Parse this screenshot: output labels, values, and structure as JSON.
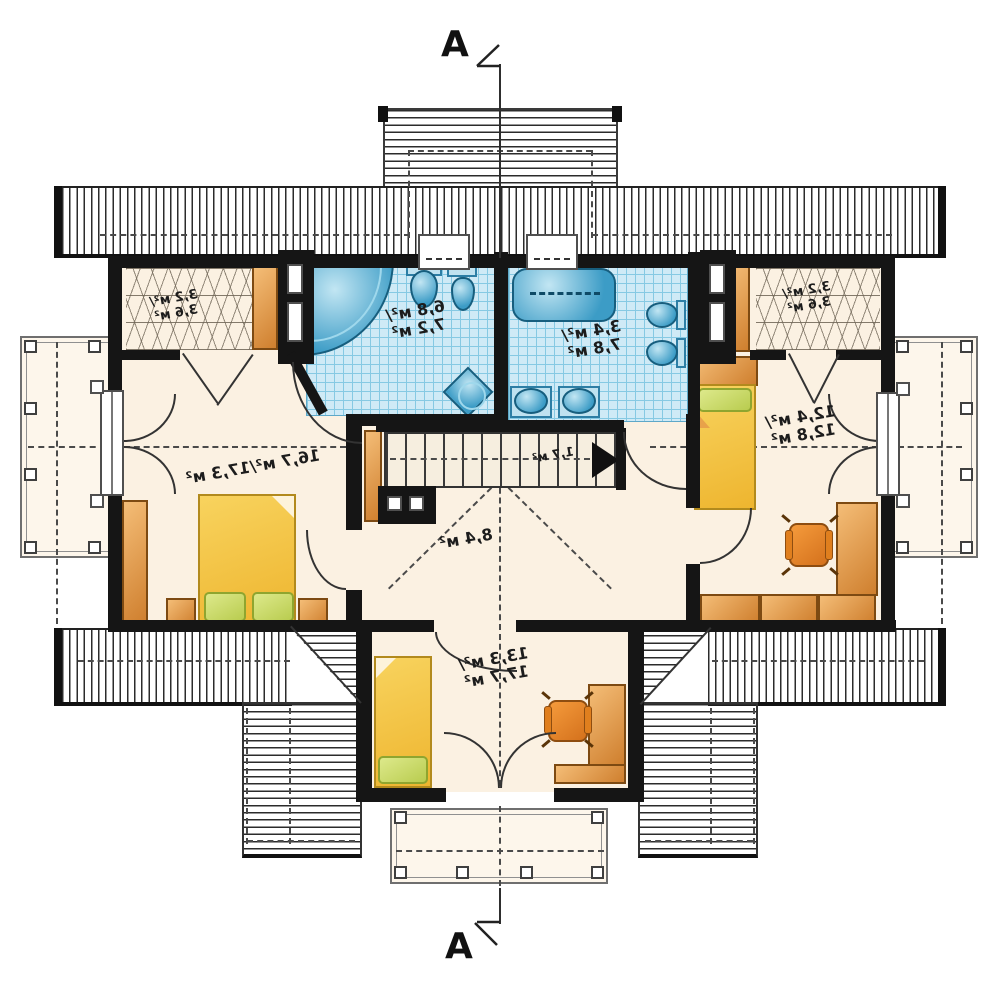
{
  "section_markers": {
    "top": "A",
    "bottom": "A"
  },
  "rooms": {
    "wardrobe_left": {
      "line1": "3,2 м²/",
      "line2": "3,6 м²"
    },
    "bath_left": {
      "line1": "6,8 м²/",
      "line2": "7,2 м²"
    },
    "bath_right": {
      "line1": "3,4 м²/",
      "line2": "7,8 м²"
    },
    "wardrobe_right": {
      "line1": "3,2 м²/",
      "line2": "3,6 м²"
    },
    "bedroom_right": {
      "line1": "12,4 м²/",
      "line2": "12,8 м²"
    },
    "bedroom_left": {
      "label": "16,7 м²/17,3 м²"
    },
    "stairs": {
      "label": "1,7 м²"
    },
    "hall": {
      "label": "8,4 м²"
    },
    "bedroom_bottom": {
      "line1": "13,3 м²/",
      "line2": "17,7 м²"
    }
  },
  "fixtures": {
    "bath_left": [
      "corner-bathtub",
      "washbasin",
      "toilet",
      "shower-cabin"
    ],
    "bath_right": [
      "bathtub",
      "toilet",
      "bidet",
      "washbasin",
      "washbasin"
    ],
    "furniture": [
      "wardrobe",
      "double-bed",
      "nightstand",
      "single-bed",
      "desk",
      "office-chair",
      "shelving",
      "stairs"
    ]
  },
  "colors": {
    "floor": "#fbf1e2",
    "tile": "#cfeaf6",
    "tile_grid": "#86c9e3",
    "wall": "#151515",
    "furniture": "#cf7f2e",
    "bed": "#f8d35e",
    "pillow": "#c6d75c",
    "chair": "#e07f1e",
    "fixture_blue": "#3c9cc6",
    "roof_line": "#2b2b2b"
  }
}
